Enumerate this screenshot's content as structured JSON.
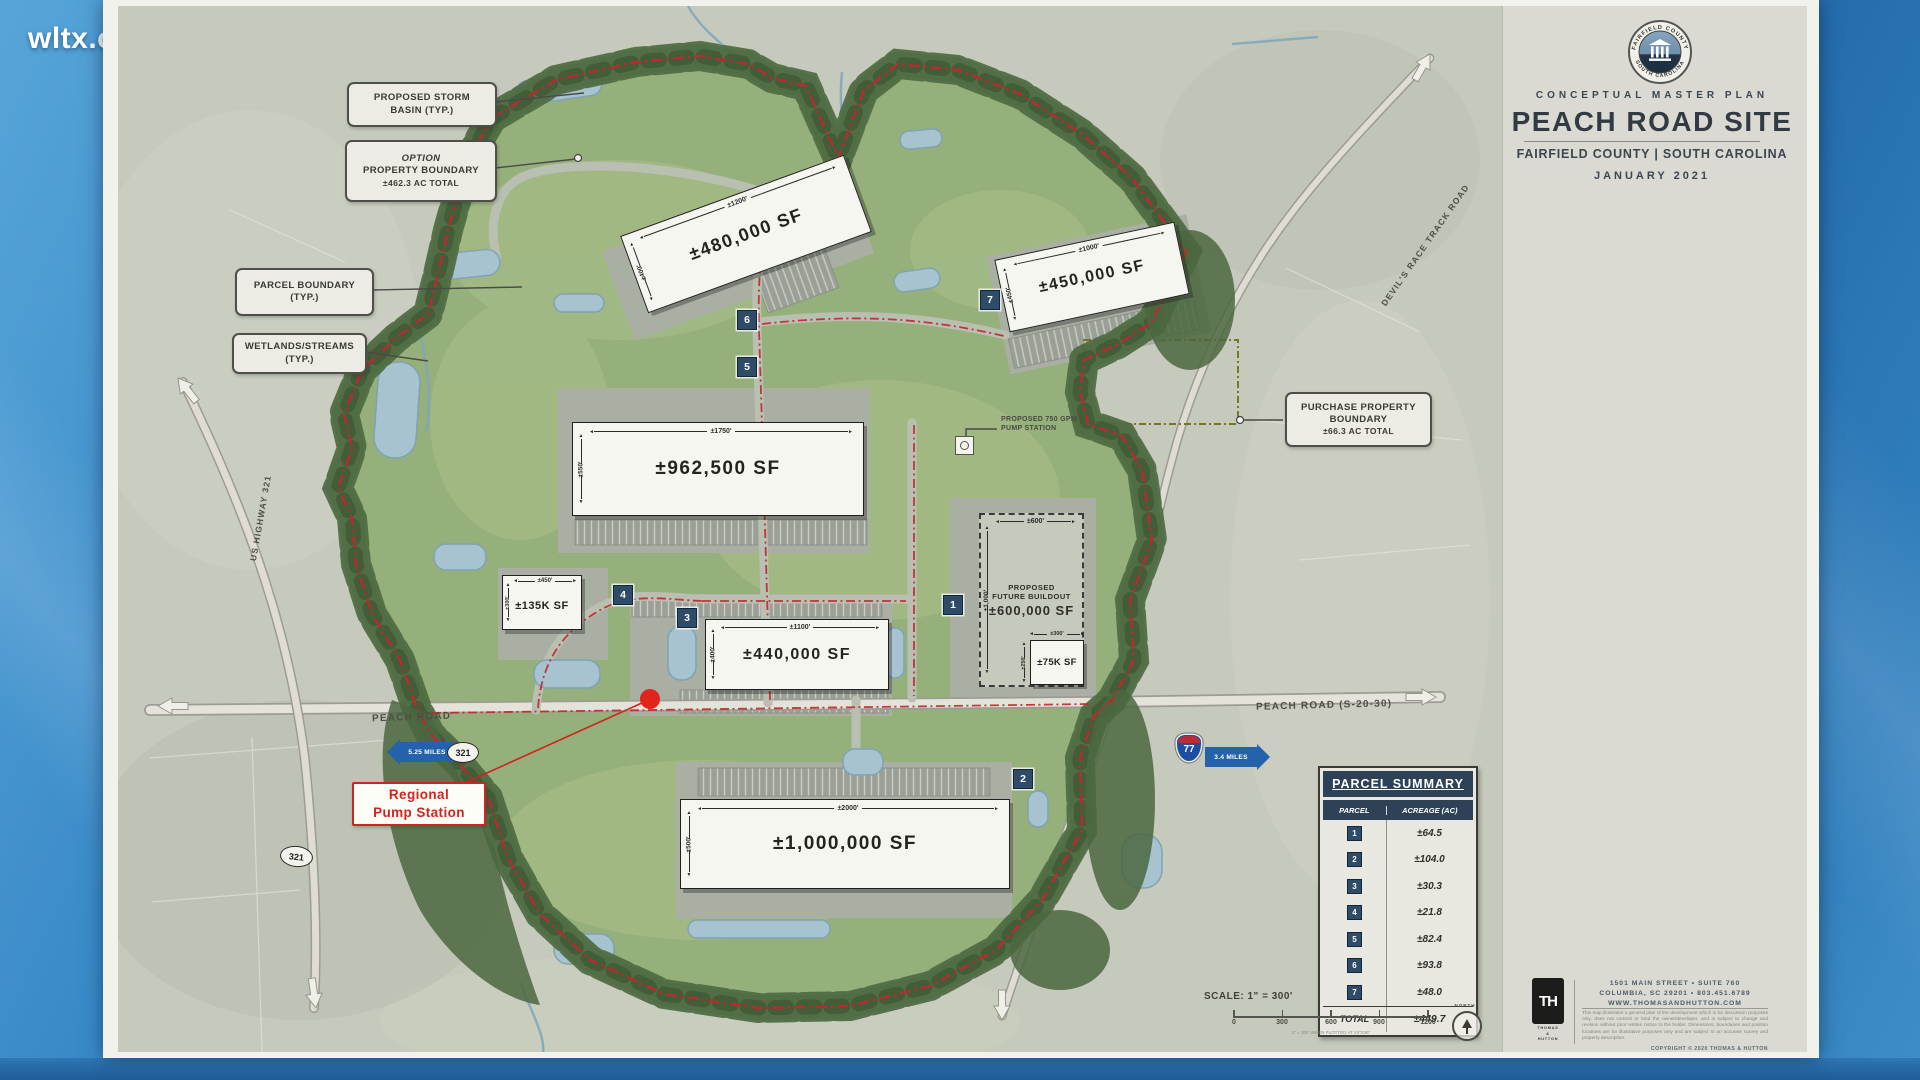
{
  "watermark": {
    "text": "wltx.com"
  },
  "title_block": {
    "seal": {
      "top": "FAIRFIELD COUNTY",
      "bottom": "SOUTH CAROLINA"
    },
    "plan_type": "CONCEPTUAL MASTER PLAN",
    "site_name": "PEACH ROAD SITE",
    "location": "FAIRFIELD COUNTY  |  SOUTH CAROLINA",
    "date": "JANUARY 2021"
  },
  "callouts": {
    "storm_basin": {
      "l1": "PROPOSED STORM",
      "l2": "BASIN (TYP.)"
    },
    "option_boundary": {
      "l1": "OPTION",
      "l2": "PROPERTY BOUNDARY",
      "l3": "±462.3 AC TOTAL"
    },
    "parcel_boundary": {
      "l1": "PARCEL BOUNDARY",
      "l2": "(TYP.)"
    },
    "wetlands": {
      "l1": "WETLANDS/STREAMS",
      "l2": "(TYP.)"
    },
    "purchase_boundary": {
      "l1": "PURCHASE PROPERTY",
      "l2": "BOUNDARY",
      "l3": "±66.3 AC TOTAL"
    },
    "pump_750": {
      "l1": "PROPOSED 750 GPM",
      "l2": "PUMP STATION"
    },
    "regional_pump": {
      "l1": "Regional",
      "l2": "Pump Station"
    }
  },
  "buildings": {
    "b480": {
      "sf": "±480,000 SF",
      "length": "±1200'",
      "width": "±400'"
    },
    "b450": {
      "sf": "±450,000 SF",
      "length": "±1000'",
      "width": "±450'"
    },
    "b962": {
      "sf": "±962,500 SF",
      "length": "±1750'",
      "width": "±550'"
    },
    "b135": {
      "sf": "±135K SF",
      "length": "±450'",
      "width": "±300'"
    },
    "b440": {
      "sf": "±440,000 SF",
      "length": "±1100'",
      "width": "±400'"
    },
    "b600": {
      "l1": "PROPOSED",
      "l2": "FUTURE BUILDOUT",
      "sf": "±600,000 SF",
      "length": "±600'",
      "width": "±1,000'"
    },
    "b75": {
      "sf": "±75K SF",
      "length": "±300'",
      "width": "±250'"
    },
    "b1000": {
      "sf": "±1,000,000 SF",
      "length": "±2000'",
      "width": "±500'"
    }
  },
  "roads": {
    "peach_west": "PEACH ROAD",
    "peach_east": "PEACH ROAD (S-20-30)",
    "devils": "DEVIL'S RACE TRACK ROAD",
    "us321": "US HIGHWAY 321",
    "shield_321": "321",
    "shield_77": "77",
    "miles_west": "5.25 MILES",
    "miles_east": "3.4 MILES"
  },
  "summary_table": {
    "title": "PARCEL SUMMARY",
    "col_parcel": "PARCEL",
    "col_acreage": "ACREAGE (AC)",
    "rows": [
      {
        "parcel": "1",
        "acreage": "±64.5"
      },
      {
        "parcel": "2",
        "acreage": "±104.0"
      },
      {
        "parcel": "3",
        "acreage": "±30.3"
      },
      {
        "parcel": "4",
        "acreage": "±21.8"
      },
      {
        "parcel": "5",
        "acreage": "±82.4"
      },
      {
        "parcel": "6",
        "acreage": "±93.8"
      },
      {
        "parcel": "7",
        "acreage": "±48.0"
      }
    ],
    "total_label": "TOTAL",
    "total_value": "±449.7"
  },
  "scale": {
    "label": "SCALE: 1\" = 300'",
    "ticks": [
      "0",
      "300",
      "600",
      "900",
      "1200"
    ],
    "note": "1\" = 300' WHEN PLOTTED AT 24\"X36\"",
    "north": "NORTH"
  },
  "firm": {
    "monogram": "TH",
    "name_l1": "THOMAS",
    "name_l2": "&",
    "name_l3": "HUTTON",
    "address1": "1501 MAIN STREET • SUITE 760",
    "address2": "COLUMBIA, SC 29201 • 803.451.6789",
    "website": "WWW.THOMASANDHUTTON.COM",
    "disclaimer": "This map illustrates a general plan of the development which is for discussion purposes only, does not commit or bind the owner/developer, and is subject to change and revision without prior written notice to the holder. Dimensions, boundaries and position locations are for illustrative purposes only and are subject to an accurate survey and property description.",
    "copyright": "COPYRIGHT © 2020  THOMAS & HUTTON"
  },
  "colors": {
    "accent_navy": "#2d4257",
    "boundary_red": "#c1272d",
    "arrow_blue": "#2462ac",
    "purchase_olive": "#77771f",
    "pump_red": "#e1251b"
  }
}
